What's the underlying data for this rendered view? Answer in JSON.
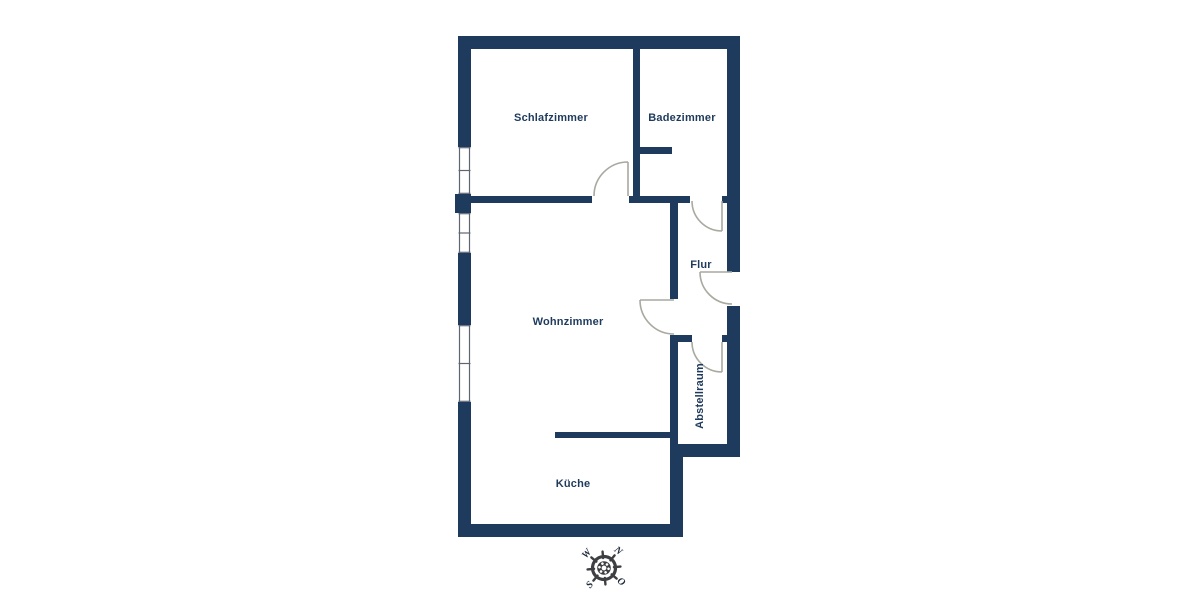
{
  "title": "Grundriss",
  "colors": {
    "wall": "#1e3a5c",
    "label": "#1e3a5c",
    "door": "#a9a9a0",
    "window": "#5f6672",
    "compass": "#3d3f42",
    "compasstext": "#1e2a3a"
  },
  "rooms": [
    {
      "id": "schlafzimmer",
      "label": "Schlafzimmer"
    },
    {
      "id": "badezimmer",
      "label": "Badezimmer"
    },
    {
      "id": "flur",
      "label": "Flur"
    },
    {
      "id": "wohnzimmer",
      "label": "Wohnzimmer"
    },
    {
      "id": "abstellraum",
      "label": "Abstellraum"
    },
    {
      "id": "kueche",
      "label": "Küche"
    }
  ],
  "compass": {
    "north": "N",
    "east": "O",
    "south": "S",
    "west": "W"
  }
}
